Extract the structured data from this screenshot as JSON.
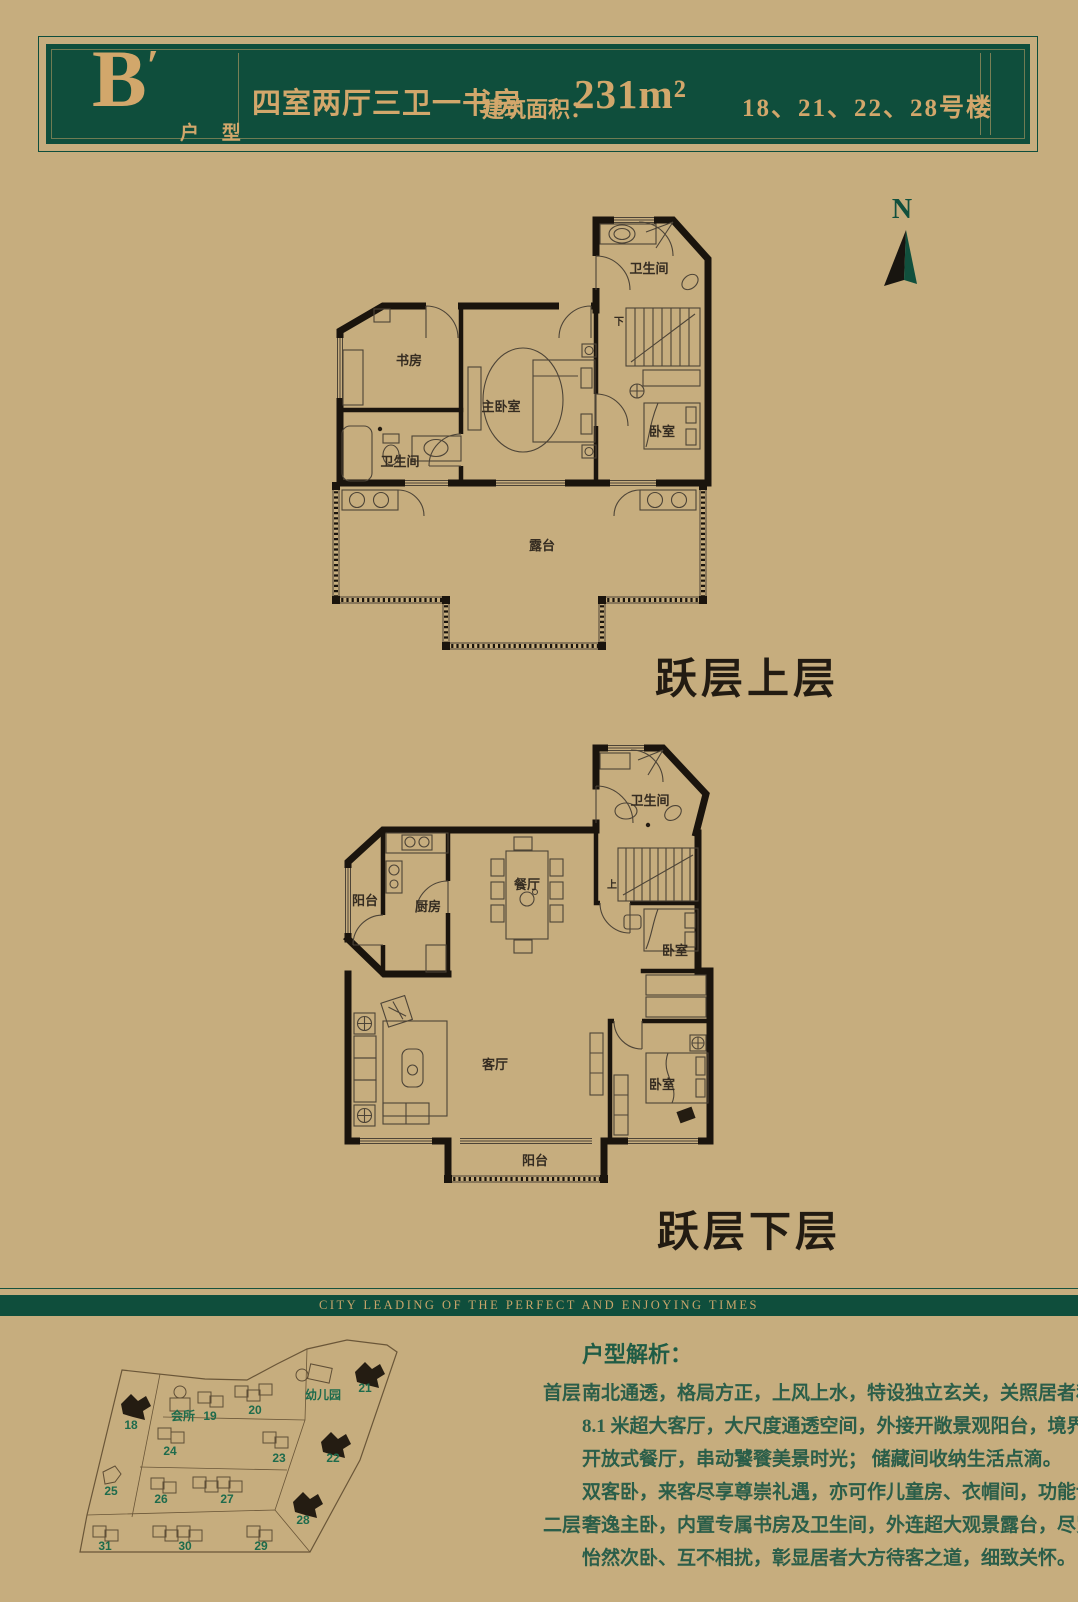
{
  "header": {
    "unit_letter": "B",
    "unit_prime": "′",
    "unit_type_label": "户 型",
    "layout_text": "四室两厅三卫一书房",
    "area_label": "建筑面积：",
    "area_value": "231m²",
    "buildings_text": "18、21、22、28号楼"
  },
  "compass": {
    "north_label": "N"
  },
  "plan_upper": {
    "caption": "跃层上层",
    "stairs_label": "下",
    "rooms": {
      "bath_top": "卫生间",
      "study": "书房",
      "bath": "卫生间",
      "master": "主卧室",
      "bedroom": "卧室",
      "terrace": "露台"
    }
  },
  "plan_lower": {
    "caption": "跃层下层",
    "stairs_label": "上",
    "rooms": {
      "bath": "卫生间",
      "balcony": "阳台",
      "kitchen": "厨房",
      "dining": "餐厅",
      "bedroom_mid": "卧室",
      "living": "客厅",
      "bedroom_low": "卧室",
      "balcony_low": "阳台"
    }
  },
  "divider": {
    "slogan": "CITY LEADING OF THE PERFECT AND ENJOYING TIMES"
  },
  "sitemap": {
    "labels": [
      {
        "t": "18",
        "x": 76,
        "y": 107
      },
      {
        "t": "会所",
        "x": 128,
        "y": 98
      },
      {
        "t": "19",
        "x": 155,
        "y": 98
      },
      {
        "t": "20",
        "x": 200,
        "y": 92
      },
      {
        "t": "幼儿园",
        "x": 268,
        "y": 77
      },
      {
        "t": "21",
        "x": 310,
        "y": 70
      },
      {
        "t": "24",
        "x": 115,
        "y": 133
      },
      {
        "t": "23",
        "x": 224,
        "y": 140
      },
      {
        "t": "22",
        "x": 278,
        "y": 140
      },
      {
        "t": "25",
        "x": 56,
        "y": 173
      },
      {
        "t": "26",
        "x": 106,
        "y": 181
      },
      {
        "t": "27",
        "x": 172,
        "y": 181
      },
      {
        "t": "28",
        "x": 248,
        "y": 202
      },
      {
        "t": "31",
        "x": 50,
        "y": 228
      },
      {
        "t": "30",
        "x": 130,
        "y": 228
      },
      {
        "t": "29",
        "x": 206,
        "y": 228
      }
    ]
  },
  "analysis": {
    "title": "户型解析：",
    "sections": [
      {
        "label": "首层",
        "lines": [
          "南北通透，格局方正，上风上水，特设独立玄关，关照居者私密。",
          "8.1 米超大客厅，大尺度通透空间，外接开敞景观阳台，境界尽在视野间。",
          "开放式餐厅，串动饕餮美景时光； 储藏间收纳生活点滴。",
          "双客卧，来客尽享尊崇礼遇，亦可作儿童房、衣帽间，功能设置一切随心。"
        ]
      },
      {
        "label": "二层",
        "lines": [
          "奢逸主卧，内置专属书房及卫生间，外连超大观景露台，尽览湖景、尊贵感浸润其中",
          "怡然次卧、互不相扰，彰显居者大方待客之道，细致关怀。"
        ]
      }
    ]
  },
  "colors": {
    "background": "#c6ad7e",
    "panel_green": "#0f4e3c",
    "gold": "#d2a76b",
    "text_green": "#2b5e49",
    "map_green": "#1e6b4c",
    "line_dark": "#1a140d"
  }
}
